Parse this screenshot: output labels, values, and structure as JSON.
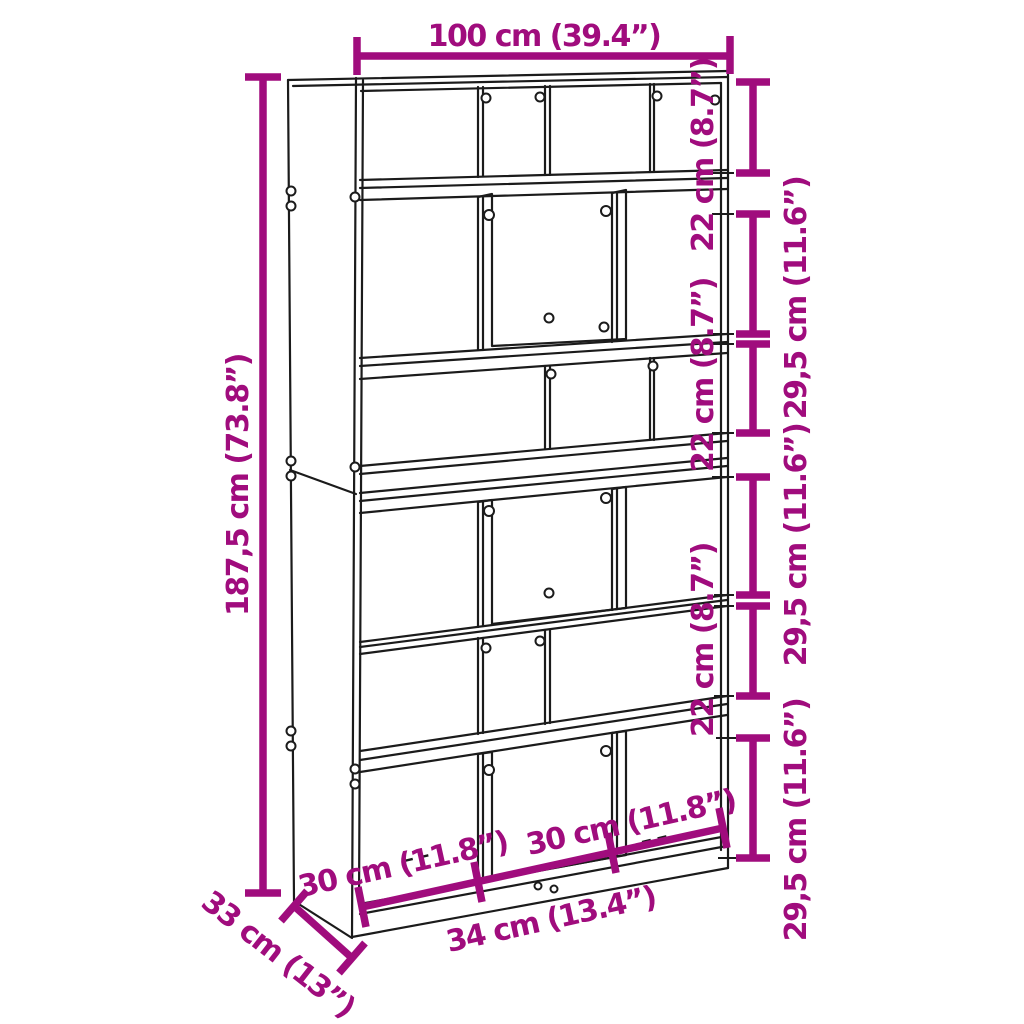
{
  "diagram": {
    "kind": "furniture-dimension-line-drawing",
    "subject": "tall bookcase / room divider with staggered compartments, drawn in light perspective",
    "colors": {
      "dimension_accent": "#A00C7D",
      "outline": "#1B1B1B",
      "background": "#FFFFFF"
    },
    "overall": {
      "width_label": "100 cm (39.4”)",
      "height_label": "187,5 cm (73.8”)",
      "depth_label": "33 cm (13”)"
    },
    "compartments": {
      "small_height_label": "22 cm (8.7”)",
      "large_height_label": "29,5 cm (11.6”)",
      "outer_width_label": "30 cm (11.8”)",
      "middle_width_label": "34 cm (13.4”)"
    }
  }
}
